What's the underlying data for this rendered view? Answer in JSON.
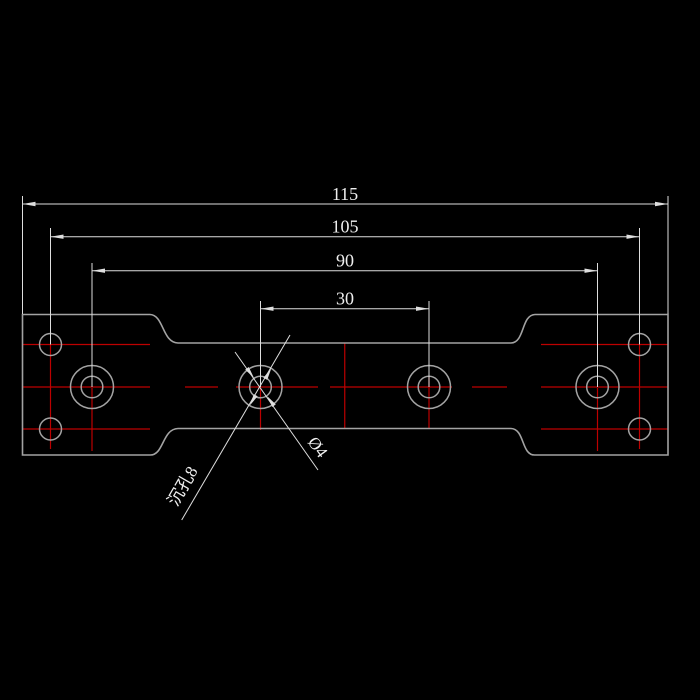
{
  "drawing": {
    "colors": {
      "background": "#000000",
      "outline": "#a3a3a3",
      "centerline": "#bd0000",
      "dimension": "#dedede",
      "text": "#efefef"
    },
    "dimensions": {
      "overall_length": {
        "label": "115"
      },
      "small_hole_spacing": {
        "label": "105"
      },
      "large_hole_spacing": {
        "label": "90"
      },
      "center_hole_spacing": {
        "label": "30"
      }
    },
    "annotations": {
      "counterbore": {
        "label": "沉孔8"
      },
      "through_hole": {
        "label": "Ø4"
      }
    }
  }
}
